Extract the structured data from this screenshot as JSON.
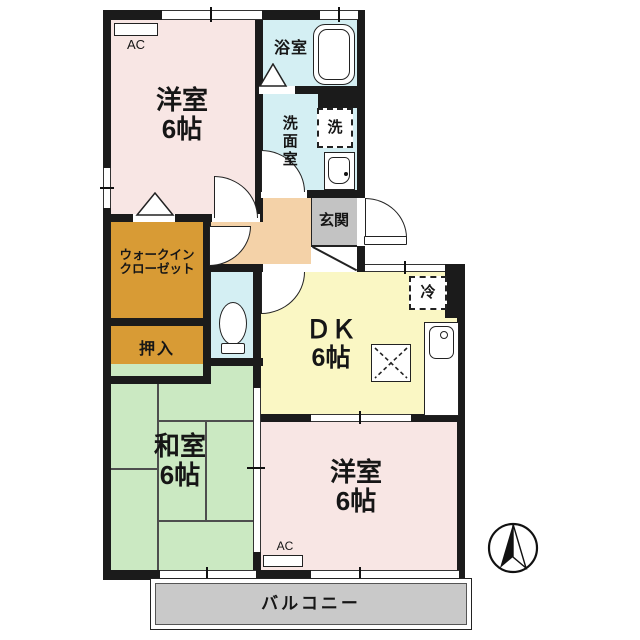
{
  "colors": {
    "western_room": "#F8E6E4",
    "wet_area": "#D4EFF3",
    "hallway": "#F4D2A8",
    "entrance_floor": "#C3C3C3",
    "closet": "#D89B35",
    "japanese_room": "#CBE9C2",
    "dining_kitchen": "#FAF7C4",
    "balcony": "#C9C9C9",
    "wall": "#1B1B1B"
  },
  "rooms": {
    "western_top": {
      "name": "洋室",
      "size": "6帖"
    },
    "bath": {
      "name": "浴室"
    },
    "washroom": {
      "name": "洗面室"
    },
    "entrance": {
      "name": "玄関"
    },
    "wic": {
      "line1": "ウォークイン",
      "line2": "クローゼット"
    },
    "oshiire": {
      "name": "押入"
    },
    "dk": {
      "name": "ＤＫ",
      "size": "6帖"
    },
    "japanese": {
      "name": "和室",
      "size": "6帖"
    },
    "western_bottom": {
      "name": "洋室",
      "size": "6帖"
    },
    "balcony": {
      "name": "バルコニー"
    }
  },
  "fixtures": {
    "washing_machine": "洗",
    "refrigerator": "冷",
    "air_conditioner": "AC"
  }
}
